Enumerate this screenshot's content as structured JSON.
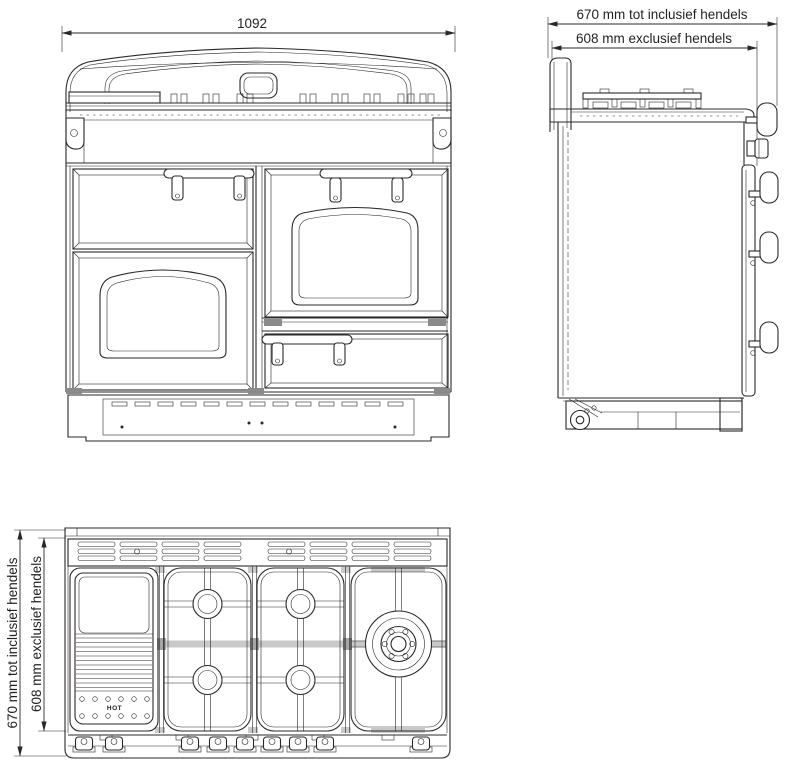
{
  "colors": {
    "line": "#2b2826",
    "background": "#ffffff",
    "shade": "#c9c9c9"
  },
  "labels": {
    "front_width": "1092",
    "side_depth_incl": "670 mm tot inclusief hendels",
    "side_depth_excl": "608 mm exclusief hendels",
    "top_depth_incl": "670 mm tot inclusief hendels",
    "top_depth_excl": "608 mm exclusief hendels",
    "griddle_hot": "HOT"
  }
}
